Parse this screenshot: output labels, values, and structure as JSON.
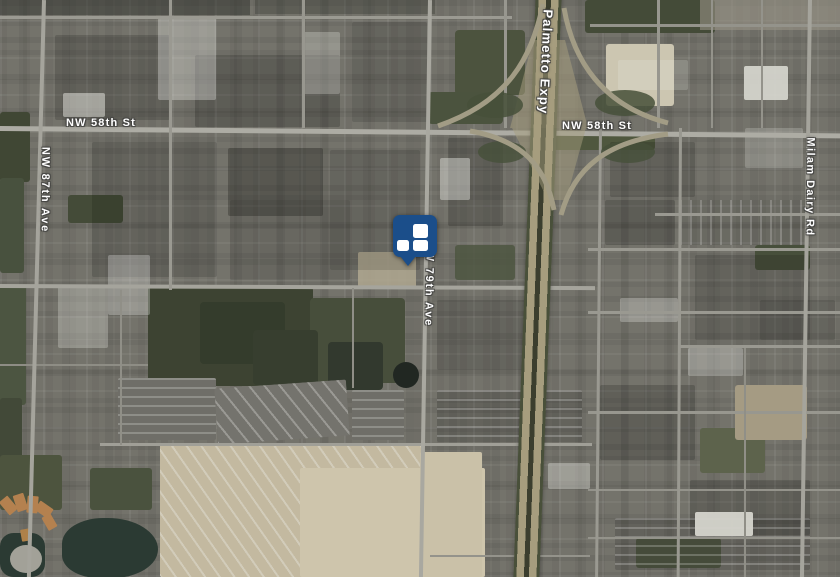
{
  "map": {
    "view_type": "satellite",
    "road_labels": {
      "palmetto_expy": "Palmetto Expy",
      "nw_58th_st_west": "NW 58th St",
      "nw_58th_st_east": "NW 58th St",
      "nw_87th_ave": "NW 87th Ave",
      "nw_79th_ave": "NW 79th Ave",
      "milam_dairy_rd": "Milam Dairy Rd"
    },
    "marker": {
      "color": "#1b4e8a",
      "tile_color": "#ffffff"
    }
  }
}
